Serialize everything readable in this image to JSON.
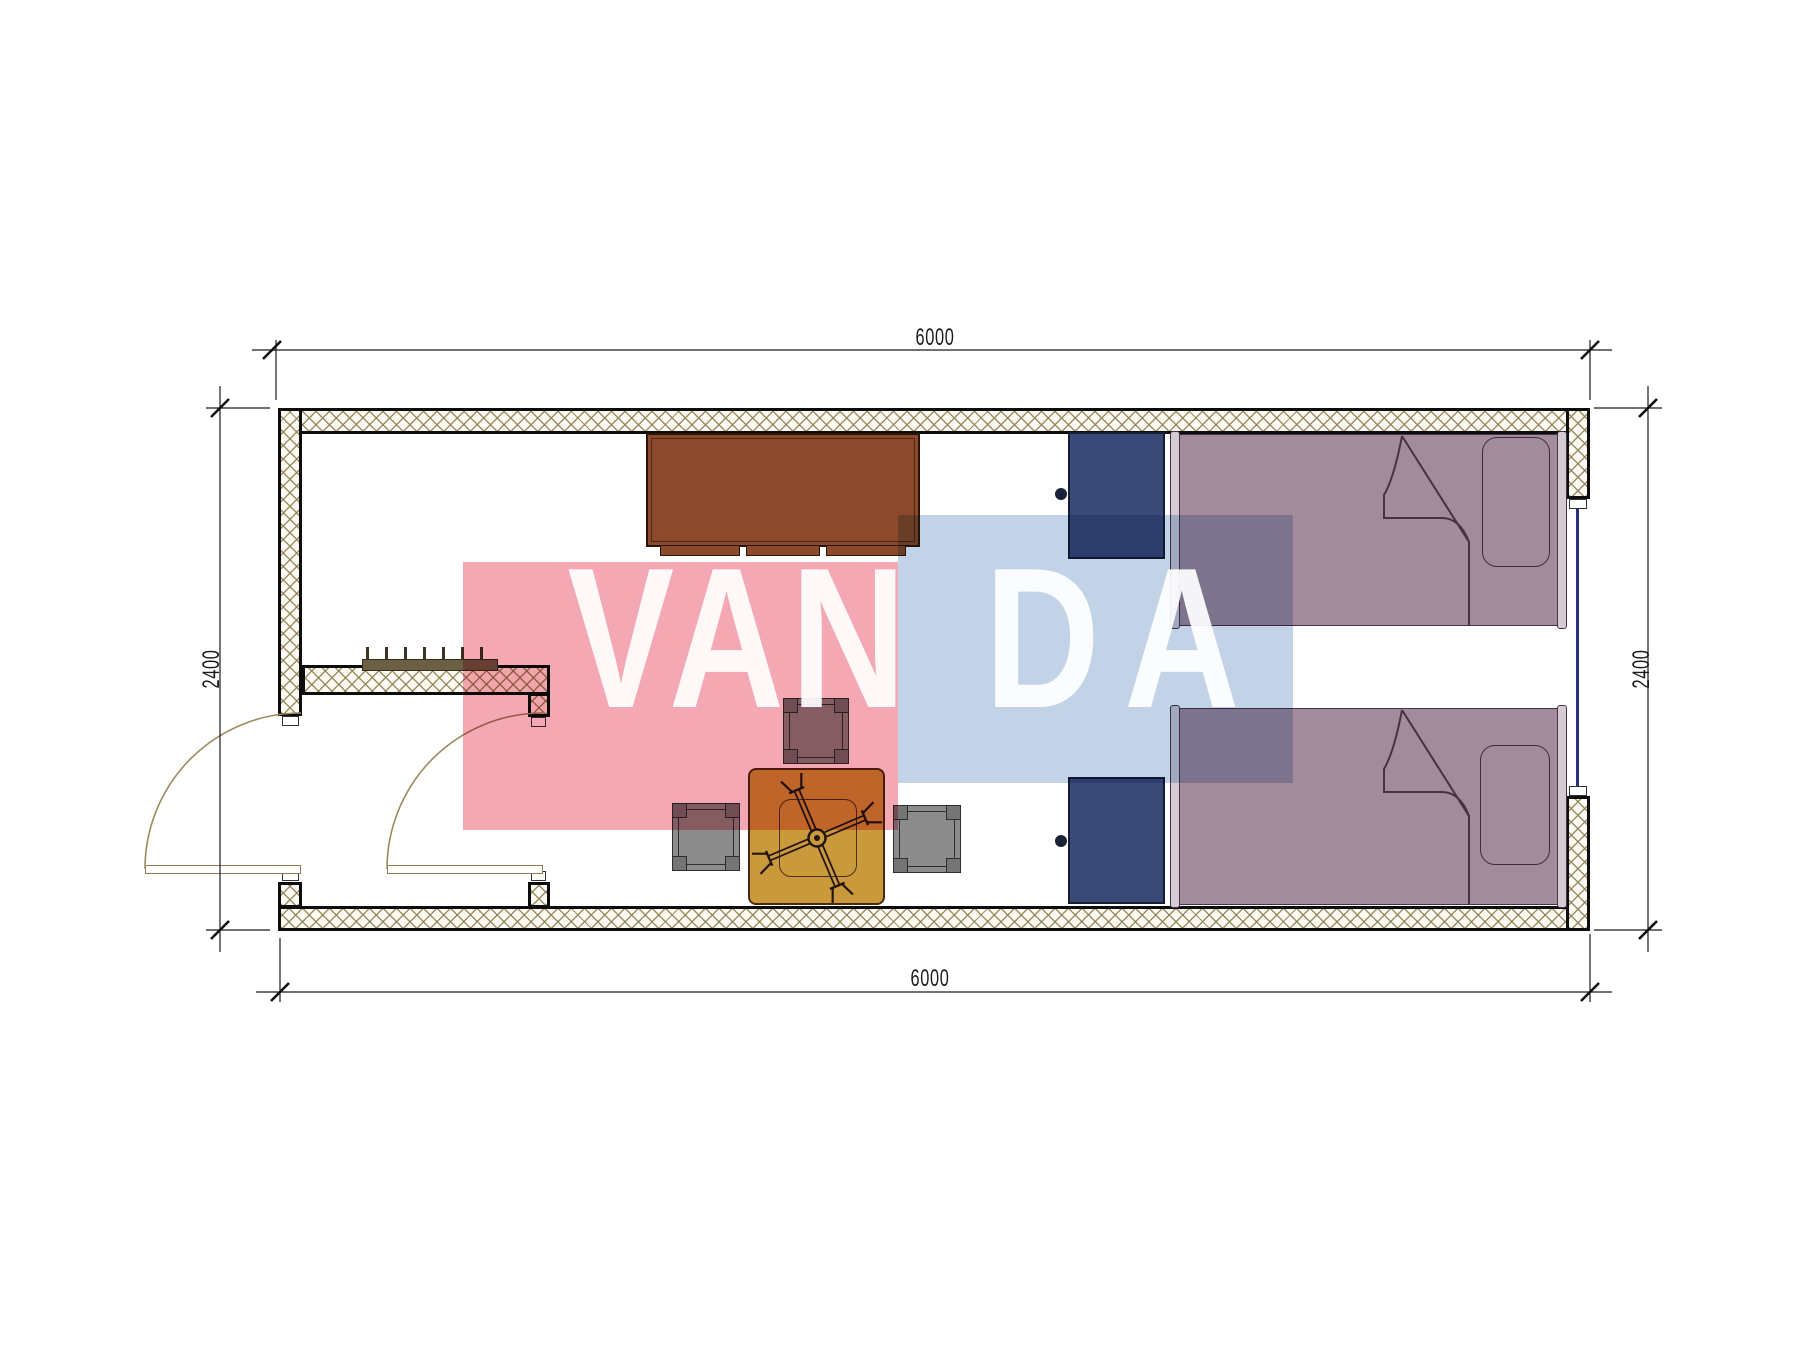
{
  "page": {
    "type": "architectural-floor-plan",
    "drawing": "container cabin bedroom plan"
  },
  "dimensions": {
    "top": {
      "label": "6000"
    },
    "bottom": {
      "label": "6000"
    },
    "left": {
      "label": "2400"
    },
    "right": {
      "label": "2400"
    }
  },
  "watermark": {
    "left_text": "VAN",
    "right_text": "DA",
    "pink_color": "#F3A8B3",
    "blue_color": "#C3D3E7",
    "text_color": "#FFFFFF"
  },
  "colors": {
    "wall_outline": "#0D0D0D",
    "wall_hatch_line": "#8B7C4D",
    "wall_hatch_bg": "#FCFAF2",
    "cabinet": "#8B4A2B",
    "wardrobe": "#3A4977",
    "bed": "#A28C9B",
    "bed_rail": "#D4CCD2",
    "pillow": "#A28C9B",
    "table": "#C9993C",
    "stool": "#8C8C8C",
    "radiator": "#6B6044",
    "window_glazing": "#25307E",
    "door_swing": "#9B8B5E",
    "fold_line": "#4B2F44",
    "dimension_line": "#1A1A1A"
  }
}
